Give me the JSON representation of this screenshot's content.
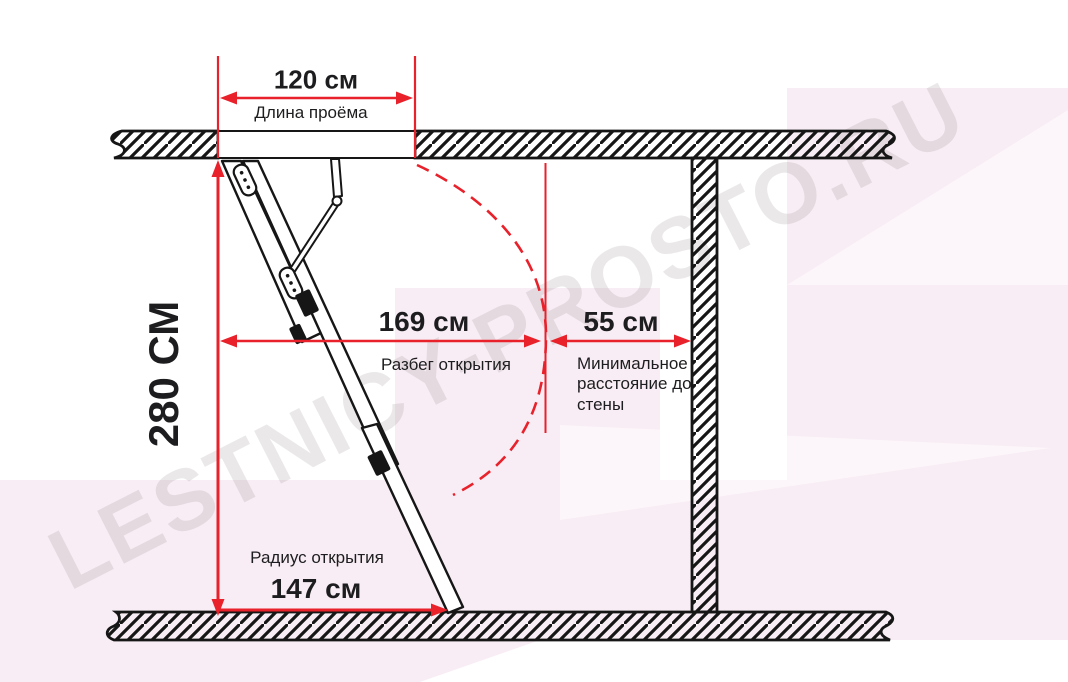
{
  "title": "Attic ladder opening dimensions diagram",
  "colors": {
    "accent_red": "#e8212b",
    "diagram_ink": "#161616",
    "label_text": "#1d1d1f",
    "background_pink": "#f8edf4",
    "watermark_gray": "rgba(125,110,120,0.16)"
  },
  "watermark": {
    "text": "LESTNICY-PROSTO.RU"
  },
  "dimensions": {
    "opening_width": {
      "value": "120 см",
      "label": "Длина проёма"
    },
    "ceiling_height": {
      "value": "280 СМ"
    },
    "opening_span": {
      "value": "169 см",
      "label": "Разбег открытия"
    },
    "wall_distance": {
      "value": "55 см",
      "label": "Минимальное расстояние до стены"
    },
    "opening_radius": {
      "value": "147 см",
      "label": "Радиус открытия"
    }
  }
}
